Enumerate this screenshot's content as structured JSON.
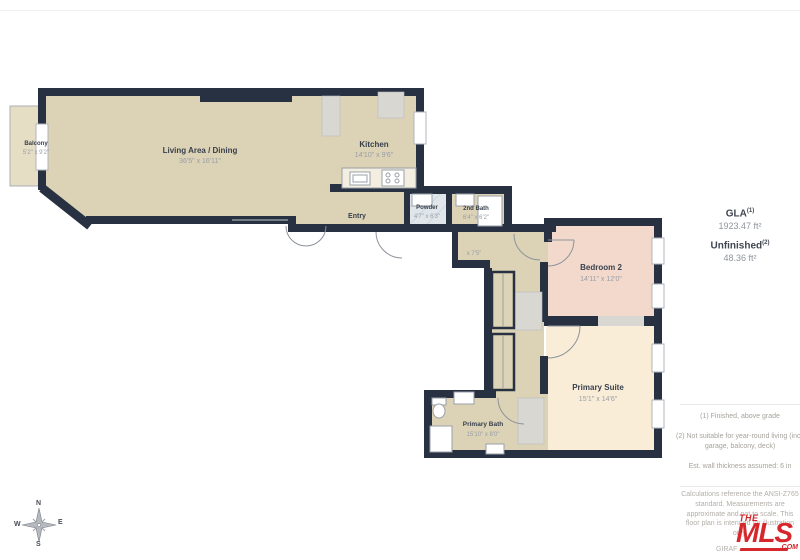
{
  "plan": {
    "rooms": {
      "balcony": {
        "label": "Balcony",
        "dims": "5'2\" x 9'2\""
      },
      "living": {
        "label": "Living Area / Dining",
        "dims": "36'5\" x 16'11\""
      },
      "kitchen": {
        "label": "Kitchen",
        "dims": "14'10\" x 9'6\""
      },
      "entry": {
        "label": "Entry"
      },
      "powder": {
        "label": "Powder",
        "dims": "4'7\" x 6'3\""
      },
      "second_bath": {
        "label": "2nd Bath",
        "dims": "6'4\" x 6'2\""
      },
      "hallway": {
        "label": "Hallway",
        "dims": "x 7'5\""
      },
      "bedroom2": {
        "label": "Bedroom 2",
        "dims": "14'11\" x 12'0\""
      },
      "primary_suite": {
        "label": "Primary Suite",
        "dims": "15'1\" x 14'6\""
      },
      "primary_bath": {
        "label": "Primary Bath",
        "dims": "15'10\" x 8'0\""
      }
    },
    "colors": {
      "wall": "#273141",
      "room_beige": "#dcd2b5",
      "bedroom_pink": "#f2d9cc",
      "suite_cream": "#f9edd8",
      "tile_blue": "#e0e6ea",
      "closet_gray": "#d8d7d2",
      "logo_red": "#d6272c"
    }
  },
  "side_panel": {
    "gla_label": "GLA",
    "gla_sup": "(1)",
    "gla_value": "1923.47 ft²",
    "unfinished_label": "Unfinished",
    "unfinished_sup": "(2)",
    "unfinished_value": "48.36 ft²",
    "notes": [
      "(1) Finished, above grade",
      "(2) Not suitable for year-round living (incl. garage, balcony, deck)",
      "Est. wall thickness assumed: 6 in"
    ],
    "disclaimer_lines": [
      "Calculations reference the ANSI-Z765",
      "standard. Measurements are",
      "approximate and not to scale. This",
      "floor plan is intended for illustration",
      "only."
    ],
    "watermark": "GIRAF"
  },
  "logo": {
    "the": "THE",
    "mls": "MLS",
    "com": ".COM"
  },
  "compass": {
    "n": "N",
    "w": "W",
    "e": "E",
    "s": "S"
  }
}
